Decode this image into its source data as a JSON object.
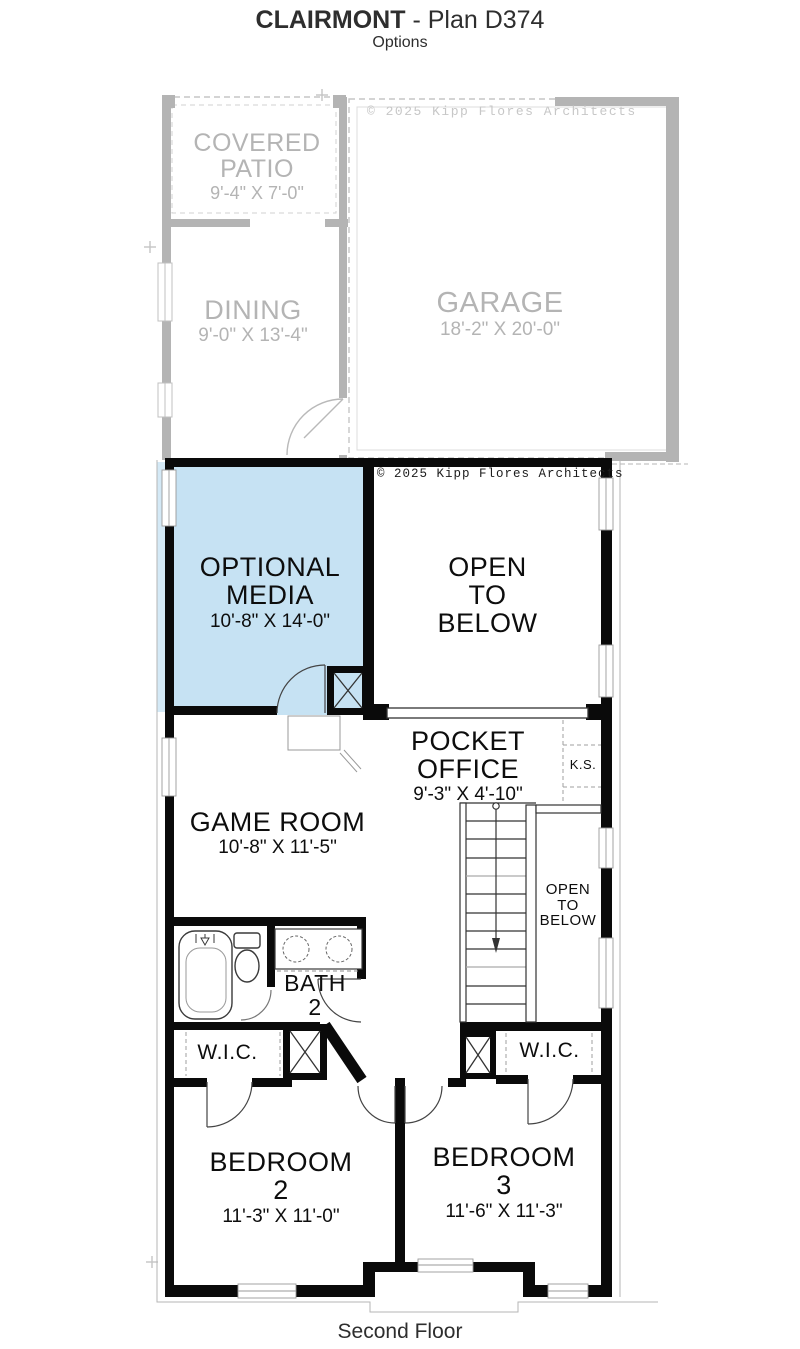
{
  "header": {
    "title_bold": "CLAIRMONT",
    "title_rest": " - Plan D374",
    "subtitle": "Options"
  },
  "footer": {
    "floor_label": "Second Floor"
  },
  "copyright": {
    "first_floor": "© 2025 Kipp Flores Architects",
    "second_floor": "© 2025 Kipp Flores Architects"
  },
  "first_floor": {
    "covered_patio": {
      "line1": "COVERED",
      "line2": "PATIO",
      "dims": "9'-4\" X 7'-0\""
    },
    "dining": {
      "line1": "DINING",
      "dims": "9'-0\" X 13'-4\""
    },
    "garage": {
      "line1": "GARAGE",
      "dims": "18'-2\" X 20'-0\""
    }
  },
  "second_floor": {
    "optional_media": {
      "line1": "OPTIONAL",
      "line2": "MEDIA",
      "dims": "10'-8\" X 14'-0\""
    },
    "open_to_below_large": {
      "line1": "OPEN",
      "line2": "TO",
      "line3": "BELOW"
    },
    "pocket_office": {
      "line1": "POCKET",
      "line2": "OFFICE",
      "dims": "9'-3\" X 4'-10\""
    },
    "kneespace": {
      "label": "K.S."
    },
    "game_room": {
      "line1": "GAME ROOM",
      "dims": "10'-8\" X 11'-5\""
    },
    "open_to_below_small": {
      "line1": "OPEN",
      "line2": "TO",
      "line3": "BELOW"
    },
    "bath_2": {
      "line1": "BATH",
      "line2": "2"
    },
    "wic_left": {
      "label": "W.I.C."
    },
    "wic_right": {
      "label": "W.I.C."
    },
    "bedroom_2": {
      "line1": "BEDROOM",
      "line2": "2",
      "dims": "11'-3\" X 11'-0\""
    },
    "bedroom_3": {
      "line1": "BEDROOM",
      "line2": "3",
      "dims": "11'-6\" X 11'-3\""
    }
  },
  "colors": {
    "media_highlight": "#c6e2f3",
    "ghost_gray": "#b4b4b4",
    "wall_black": "#0a0a0a"
  }
}
